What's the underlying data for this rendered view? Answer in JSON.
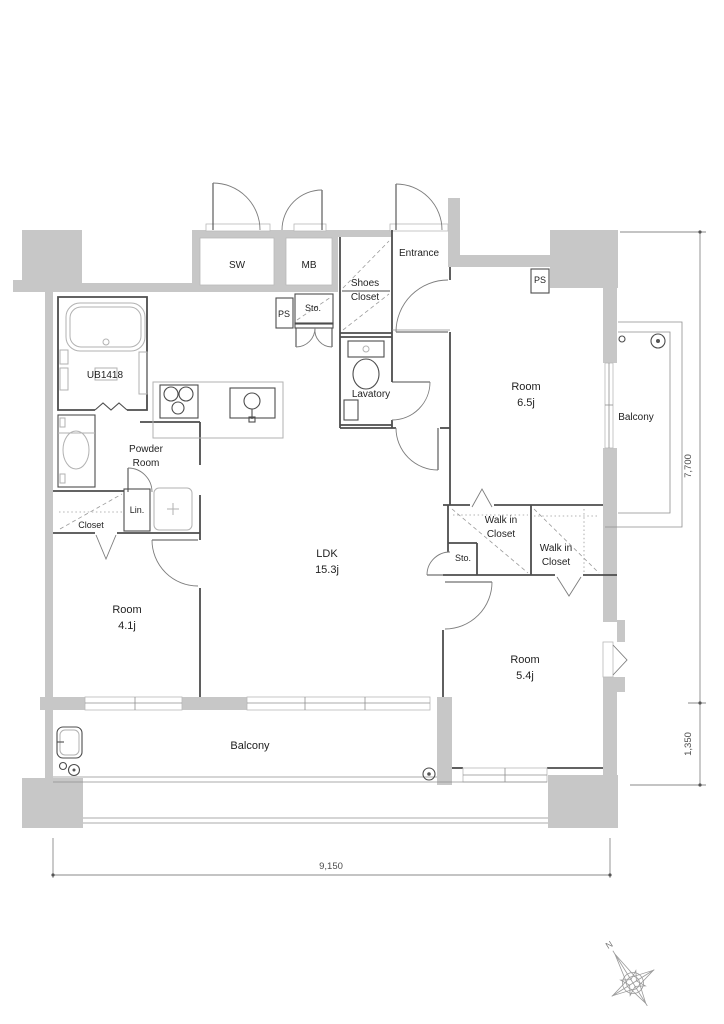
{
  "rooms": {
    "ldk": {
      "name": "LDK",
      "size": "15.3j"
    },
    "room_65": {
      "name": "Room",
      "size": "6.5j"
    },
    "room_41": {
      "name": "Room",
      "size": "4.1j"
    },
    "room_54": {
      "name": "Room",
      "size": "5.4j"
    },
    "balcony_south": "Balcony",
    "balcony_east": "Balcony",
    "powder_room": {
      "line1": "Powder",
      "line2": "Room"
    },
    "lavatory": "Lavatory",
    "entrance": "Entrance",
    "shoes_closet": {
      "line1": "Shoes",
      "line2": "Closet"
    },
    "wic_a": {
      "line1": "Walk in",
      "line2": "Closet"
    },
    "wic_b": {
      "line1": "Walk in",
      "line2": "Closet"
    },
    "closet": "Closet",
    "linen": "Lin.",
    "storage_hall": "Sto.",
    "storage_ldk": "Sto.",
    "ps_hall": "PS",
    "ps_east": "PS",
    "unit_bath": "UB1418",
    "meter_box": "MB",
    "service_box": "SW"
  },
  "dimensions": {
    "east_main": "7,700",
    "east_balcony": "1,350",
    "south": "9,150"
  },
  "compass": {
    "north": "N"
  },
  "colors": {
    "wall_fill": "#c7c7c7",
    "wall_line": "#4d4d4d",
    "fixture_line": "#b2b2b2",
    "text": "#1f1f1f"
  }
}
